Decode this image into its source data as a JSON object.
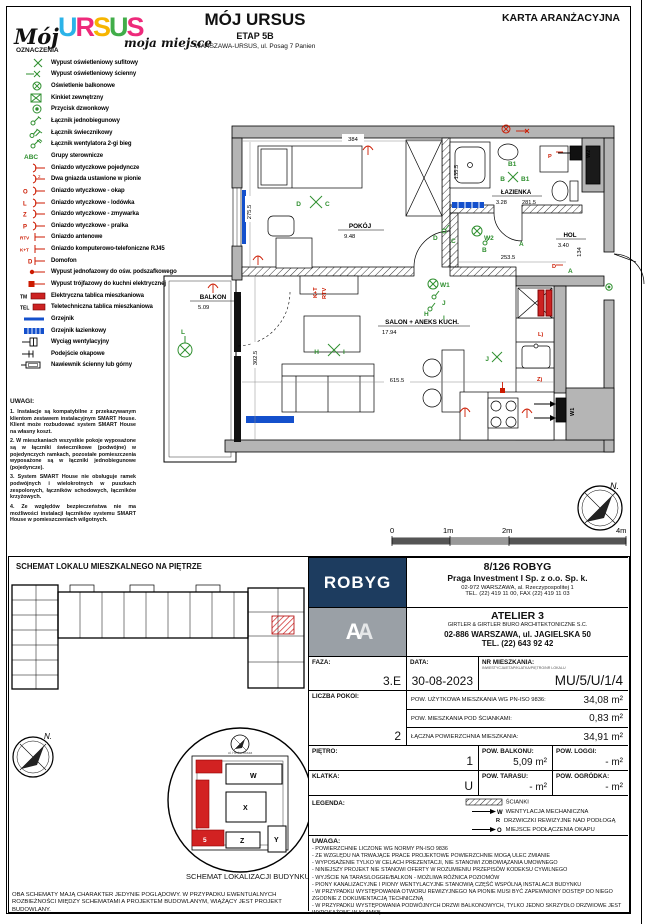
{
  "header": {
    "logo_script": "Mój",
    "logo_brand": [
      "U",
      "R",
      "S",
      "U",
      "S"
    ],
    "logo_tagline": "moja miejsce",
    "oznaczenia": "OZNACZENIA",
    "title": "MÓJ URSUS",
    "etap": "ETAP 5B",
    "address": "WARSZAWA-URSUS, ul. Posag 7 Panien",
    "card": "KARTA ARANŻACYJNA"
  },
  "legend": {
    "items": [
      {
        "label": "Wypust oświetleniowy sufitowy"
      },
      {
        "label": "Wypust oświetleniowy ścienny"
      },
      {
        "label": "Oświetlenie balkonowe"
      },
      {
        "label": "Kinkiet zewnętrzny"
      },
      {
        "label": "Przycisk dzwonkowy"
      },
      {
        "label": "Łącznik jednobiegunowy"
      },
      {
        "label": "Łącznik świecznikowy"
      },
      {
        "label": "Łącznik wentylatora 2-gi bieg"
      },
      {
        "label": "Grupy sterownicze",
        "prefix": "ABC"
      },
      {
        "label": "Gniazdo wtyczkowe pojedyncze"
      },
      {
        "label": "Dwa gniazda ustawione w pionie",
        "prefix": "2"
      },
      {
        "label": "Gniazdo wtyczkowe - okap",
        "prefix": "O"
      },
      {
        "label": "Gniazdo wtyczkowe - lodówka",
        "prefix": "L"
      },
      {
        "label": "Gniazdo wtyczkowe - zmywarka",
        "prefix": "Z"
      },
      {
        "label": "Gniazdo wtyczkowe - pralka",
        "prefix": "P"
      },
      {
        "label": "Gniazdo antenowe",
        "prefix": "RTV"
      },
      {
        "label": "Gniazdo komputerowo-telefoniczne RJ45",
        "prefix": "K+T"
      },
      {
        "label": "Domofon",
        "prefix": "D"
      },
      {
        "label": "Wypust jednofazowy do ośw. podszafkowego"
      },
      {
        "label": "Wypust trójfazowy do kuchni elektrycznej"
      },
      {
        "label": "Elektryczna tablica mieszkaniowa",
        "prefix": "TM"
      },
      {
        "label": "Teletechniczna tablica mieszkaniowa",
        "prefix": "TEL"
      },
      {
        "label": "Grzejnik"
      },
      {
        "label": "Grzejnik łazienkowy"
      },
      {
        "label": "Wyciąg wentylacyjny"
      },
      {
        "label": "Podejście okapowe"
      },
      {
        "label": "Nawiewnik ścienny lub górny"
      }
    ]
  },
  "uwagi": {
    "title": "UWAGI:",
    "notes": [
      "1. Instalacje są kompatybilne z przekazywanym klientom zestawem instalacyjnym SMART House. Klient może rozbudować system SMART House na własny koszt.",
      "2. W mieszkaniach wszystkie pokoje wyposażone są w łączniki świecznikowe (podwójne) w pojedynczych ramkach, pozostałe pomieszczenia wyposażone są w łączniki jednobiegunowe (pojedyncze).",
      "3. System SMART House nie obsługuje ramek podwójnych i wielokrotnych w puszkach zespolonych, łączników schodowych, łączników krzyżowych.",
      "4. Ze względów bezpieczeństwa nie ma możliwości instalacji łączników systemu SMART House w pomieszczeniach wilgotnych."
    ]
  },
  "plan": {
    "rooms": {
      "balkon": {
        "name": "BALKON",
        "area": "5.09"
      },
      "pokoj": {
        "name": "POKÓJ",
        "area": "9.48"
      },
      "lazienka": {
        "name": "ŁAZIENKA",
        "area": "3.28",
        "dim": "281.5"
      },
      "hol": {
        "name": "HOL",
        "area": "3.40"
      },
      "salon": {
        "name": "SALON + ANEKS KUCH.",
        "area": "17.94"
      }
    },
    "dims": {
      "pokoj_w": "384",
      "pokoj_h": "275.5",
      "shower_h": "135.5",
      "hol_w": "253.5",
      "hol_h": "134",
      "salon_w": "615.5",
      "salon_h": "302.5"
    },
    "sym": {
      "a": "A",
      "b": "B",
      "b1": "B1",
      "c": "C",
      "d": "D",
      "h": "H",
      "i": "I",
      "j": "J",
      "l": "L",
      "w1": "W1",
      "w2": "W2",
      "p": "P",
      "lsock": "L)",
      "zsock": "Z)",
      "ktt": "K+T",
      "rtv": "RTV",
      "dred": "D"
    },
    "scale": {
      "s0": "0",
      "s1": "1m",
      "s2": "2m",
      "s4": "4m"
    },
    "north": "N."
  },
  "schemat_pietro": {
    "title": "SCHEMAT LOKALU MIESZKALNEGO NA PIĘTRZE"
  },
  "schemat_budynek": {
    "title": "SCHEMAT LOKALIZACJI BUDYNKU",
    "street_top": "ul. Herbu Oksza",
    "blocks": {
      "w": "W",
      "x": "X",
      "y": "Y",
      "z": "Z",
      "unit": "5"
    }
  },
  "disclaimer": "OBA SCHEMATY MAJĄ CHARAKTER JEDYNIE POGLĄDOWY. W PRZYPADKU EWENTUALNYCH ROZBIEŻNOŚCI MIĘDZY SCHEMATAMI A PROJEKTEM BUDOWLANYM, WIĄŻĄCY JEST PROJEKT BUDOWLANY.",
  "info": {
    "robyg": {
      "logo": "ROBYG",
      "plot": "8/126 ROBYG",
      "company": "Praga Investment I Sp. z o.o. Sp. k.",
      "addr": "02-972 WARSZAWA, al. Rzeczypospolitej 1",
      "tel": "TEL. (22) 419 11 00, FAX (22) 419 11 03"
    },
    "atelier": {
      "name": "ATELIER 3",
      "sub": "GIRTLER & GIRTLER BIURO ARCHITEKTONICZNE S.C.",
      "addr": "02-886 WARSZAWA, ul. JAGIELSKA 50",
      "tel": "TEL. (22) 643 92 42"
    },
    "faza": {
      "label": "FAZA:",
      "value": "3.E"
    },
    "data": {
      "label": "DATA:",
      "value": "30-08-2023"
    },
    "nr": {
      "label": "NR MIESZKANIA:",
      "sub": "INWESTYCJA/ETAP/KLATKA/PIĘTRO/NR LOKALU",
      "value": "MU/5/U/1/4"
    },
    "pokoi": {
      "label": "LICZBA POKOI:",
      "value": "2"
    },
    "areas": [
      {
        "label": "POW. UŻYTKOWA MIESZKANIA WG PN-ISO 9836:",
        "value": "34,08  m²"
      },
      {
        "label": "POW. MIESZKANIA POD ŚCIANKAMI:",
        "value": "0,83  m²"
      },
      {
        "label": "ŁĄCZNA POWIERZCHNIA MIESZKANIA:",
        "value": "34,91  m²"
      }
    ],
    "pietro": {
      "label": "PIĘTRO:",
      "value": "1"
    },
    "balkon": {
      "label": "POW. BALKONU:",
      "value": "5,09  m²"
    },
    "loggi": {
      "label": "POW. LOGGI:",
      "value": "-  m²"
    },
    "klatka": {
      "label": "KLATKA:",
      "value": "U"
    },
    "taras": {
      "label": "POW. TARASU:",
      "value": "-  m²"
    },
    "ogrodek": {
      "label": "POW. OGRÓDKA:",
      "value": "-  m²"
    },
    "legenda2": {
      "title": "LEGENDA:",
      "scianki": "ŚCIANKI",
      "went_sym": "W",
      "went": "WENTYLACJA MECHANICZNA",
      "rew_sym": "R",
      "rew": "DRZWICZKI REWIZYJNE NAD PODŁOGĄ",
      "okap_sym": "O",
      "okap": "MIEJSCE PODŁĄCZENIA OKAPU KUCHENNEGO"
    },
    "uwaga2": {
      "title": "UWAGA:",
      "notes": [
        "- POWIERZCHNIE LICZONE WG NORMY PN-ISO 9836",
        "- ZE WZGLĘDU NA TRWAJĄCE PRACE PROJEKTOWE POWIERZCHNIE MOGĄ ULEC ZMIANIE",
        "- WYPOSAŻENIE TYLKO W CELACH PREZENTACJI, NIE STANOWI ZOBOWIĄZANIA UMOWNEGO",
        "- NINIEJSZY PROJEKT NIE STANOWI OFERTY W ROZUMIENIU PRZEPISÓW KODEKSU CYWILNEGO",
        "- WYJŚCIE NA TARAS/LOGGIE/BALKON - MOŻLIWA RÓŻNICA POZIOMÓW",
        "- PIONY KANALIZACYJNE I PIONY WENTYLACYJNE STANOWIĄ CZĘŚĆ WSPÓLNĄ INSTALACJI BUDYNKU",
        "- W PRZYPADKU WYSTĘPOWANIA OTWORU REWIZYJNEGO NA PIONIE MUSI BYĆ ZAPEWNIONY DOSTĘP DO NIEGO ZGODNIE Z DOKUMENTACJĄ TECHNICZNĄ",
        "- W PRZYPADKU WYSTĘPOWANIA PODWÓJNYCH DRZWI BALKONOWYCH, TYLKO JEDNO SKRZYDŁO DRZWIOWE JEST WYPOSAŻONE W KLAMKĘ"
      ]
    }
  }
}
